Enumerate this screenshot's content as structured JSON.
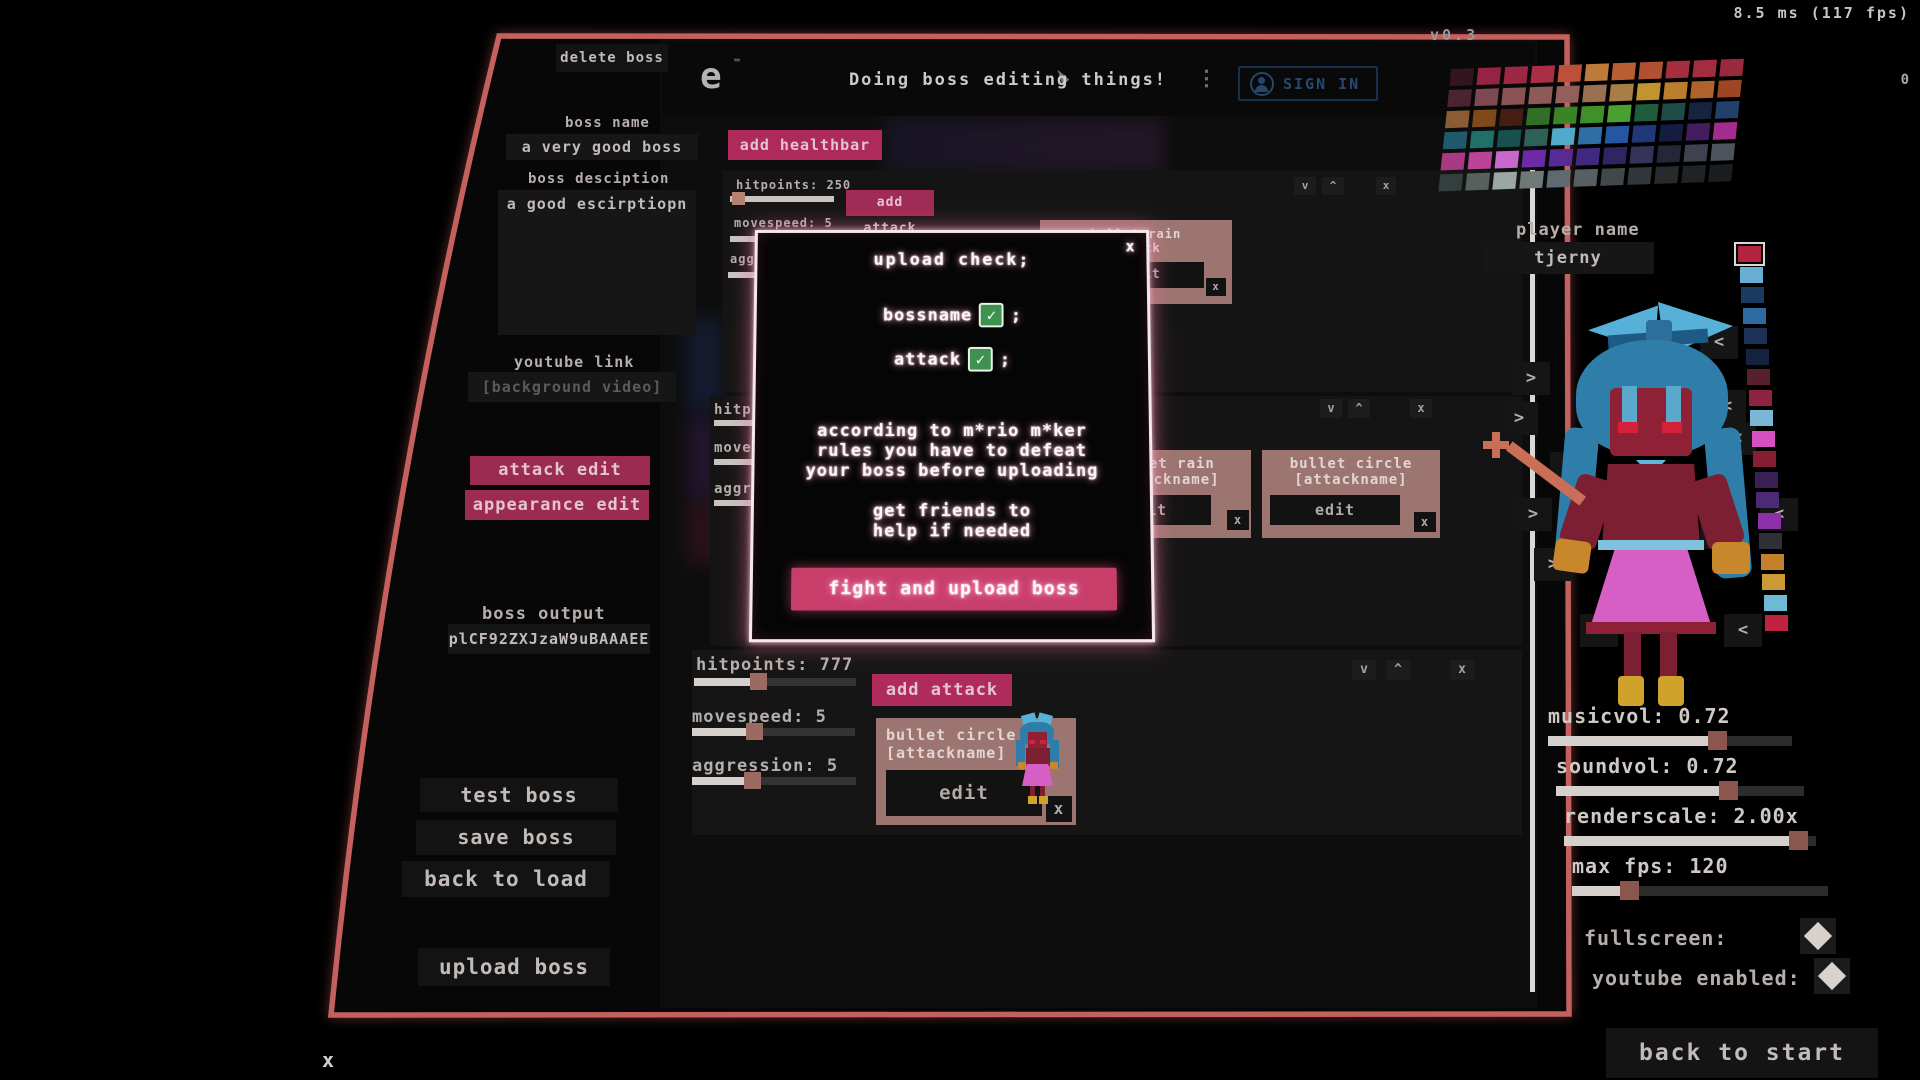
{
  "hud": {
    "perf": "8.5 ms (117 fps)",
    "perf_secondary": "0",
    "version": "v0.3",
    "bottom_close": "x"
  },
  "colors": {
    "frame": "#c4615e",
    "accent_pink": "#ad2a5b",
    "accent_pink_bright": "#c83e6b",
    "card": "#9c7570",
    "check_green": "#3f9150",
    "slider_handle": "#9b6a61",
    "slider_fill": "#d6d0cc",
    "modal_glow": "#e27096",
    "sign_in_blue": "#24476b"
  },
  "left_panel": {
    "delete_button": "delete boss",
    "boss_name_label": "boss name",
    "boss_name_value": "a very good boss",
    "boss_description_label": "boss desciption",
    "boss_description_value": "a good escirptiopn",
    "youtube_label": "youtube link",
    "youtube_placeholder": "[background video]",
    "attack_edit_button": "attack edit",
    "appearance_edit_button": "appearance edit",
    "boss_output_label": "boss output",
    "boss_output_value": "plCF92ZXJzaW9uBAAAEE",
    "test_button": "test boss",
    "save_button": "save boss",
    "back_button": "back to load",
    "upload_button": "upload boss"
  },
  "header": {
    "logo_fragment": "e",
    "logo_mark": "™",
    "title": "Doing boss editing things!",
    "menu_dots": "⋮",
    "sign_in_label": "SIGN IN"
  },
  "content": {
    "add_healthbar_label": "add healthbar",
    "panels": [
      {
        "rows": [
          {
            "label": "hitpoints: 250",
            "fill": 0.06
          },
          {
            "label": "movespeed: 5",
            "fill": 0.45
          },
          {
            "label": "aggression: 5",
            "fill": 0.45
          }
        ],
        "add_attack_label": "add attack",
        "cards": [
          {
            "line1": "bullet rain",
            "line2": "attack",
            "edit_label": "edit",
            "close_label": "x"
          }
        ],
        "controls": {
          "down": "v",
          "up": "^",
          "close": "x"
        }
      },
      {
        "rows": [
          {
            "label": "hitpoints:",
            "fill": 0.5
          },
          {
            "label": "movespeed:",
            "fill": 0.5
          },
          {
            "label": "aggression:",
            "fill": 0.5
          }
        ],
        "cards": [
          {
            "line1": "bullet rain",
            "line2": "[attackname]",
            "edit_label": "edit",
            "close_label": "x"
          },
          {
            "line1": "bullet circle",
            "line2": "[attackname]",
            "edit_label": "edit",
            "close_label": "x"
          }
        ],
        "controls": {
          "down": "v",
          "up": "^",
          "close": "x"
        }
      },
      {
        "rows": [
          {
            "label": "hitpoints: 777",
            "fill": 0.38
          },
          {
            "label": "movespeed: 5",
            "fill": 0.37
          },
          {
            "label": "aggression: 5",
            "fill": 0.35
          }
        ],
        "add_attack_label": "add attack",
        "cards": [
          {
            "line1": "bullet circle",
            "line2": "[attackname]",
            "edit_label": "edit",
            "close_label": "x"
          }
        ],
        "controls": {
          "down": "v",
          "up": "^",
          "close": "x"
        }
      }
    ]
  },
  "modal": {
    "title": "upload check;",
    "close": "x",
    "check_glyph": "✓",
    "checks": [
      {
        "label": "bossname",
        "suffix": ";"
      },
      {
        "label": "attack",
        "suffix": ";"
      }
    ],
    "body_lines": [
      "according to m*rio m*ker",
      "rules you have to defeat",
      "your boss before uploading"
    ],
    "hint_lines": [
      "get friends to",
      "help if needed"
    ],
    "action_label": "fight and upload boss"
  },
  "right_panel": {
    "player_name_label": "player name",
    "player_name_value": "tjerny",
    "arrow_left": ">",
    "arrow_right": "<",
    "palette_rows": [
      [
        "#331520",
        "#952444",
        "#9e2844",
        "#aa2e45",
        "#bc5038",
        "#bd7a3a",
        "#b95e32",
        "#b05232",
        "#a52e3e",
        "#a22c40",
        "#992a3e"
      ],
      [
        "#4a2430",
        "#7e4850",
        "#8a5356",
        "#8e5a57",
        "#92605a",
        "#997050",
        "#a67e46",
        "#c29430",
        "#ba7e2c",
        "#b0622c",
        "#9e4624"
      ],
      [
        "#8a5c36",
        "#7e4a1c",
        "#451d12",
        "#2f7026",
        "#3a8428",
        "#3f9028",
        "#48a030",
        "#1f5c3c",
        "#1e4c46",
        "#162440",
        "#21406c"
      ],
      [
        "#1f5a6c",
        "#207068",
        "#17504c",
        "#2f6058",
        "#52aaca",
        "#2f6ea2",
        "#2456a2",
        "#20387a",
        "#141c40",
        "#441d60",
        "#a42c8c"
      ],
      [
        "#a83a84",
        "#bc4498",
        "#c668ce",
        "#6c2aa4",
        "#582a94",
        "#3f2a80",
        "#302562",
        "#34335a",
        "#242738",
        "#3d424e",
        "#4d525c"
      ],
      [
        "#343e3c",
        "#58605e",
        "#9ca6a4",
        "#6e7876",
        "#5f6a70",
        "#566064",
        "#42484a",
        "#31363a",
        "#272b2e",
        "#202326",
        "#1b1e20"
      ]
    ],
    "swatch_strip": [
      "#b2243e",
      "#68aed2",
      "#1c3a60",
      "#2c6aa0",
      "#1b3156",
      "#142240",
      "#58202e",
      "#8c2442",
      "#7ab6d6",
      "#d650c2",
      "#871e34",
      "#3a2055",
      "#4c2a76",
      "#8e30a8",
      "#2e3036",
      "#c4812c",
      "#cc9a34",
      "#70b8d8",
      "#bf2340"
    ],
    "settings": [
      {
        "label": "musicvol: 0.72",
        "fill": 0.68
      },
      {
        "label": "soundvol: 0.72",
        "fill": 0.68
      },
      {
        "label": "renderscale: 2.00x",
        "fill": 0.92
      },
      {
        "label": "max fps: 120",
        "fill": 0.22
      }
    ],
    "toggles": [
      {
        "label": "fullscreen:"
      },
      {
        "label": "youtube enabled:"
      }
    ],
    "back_button": "back to start"
  }
}
